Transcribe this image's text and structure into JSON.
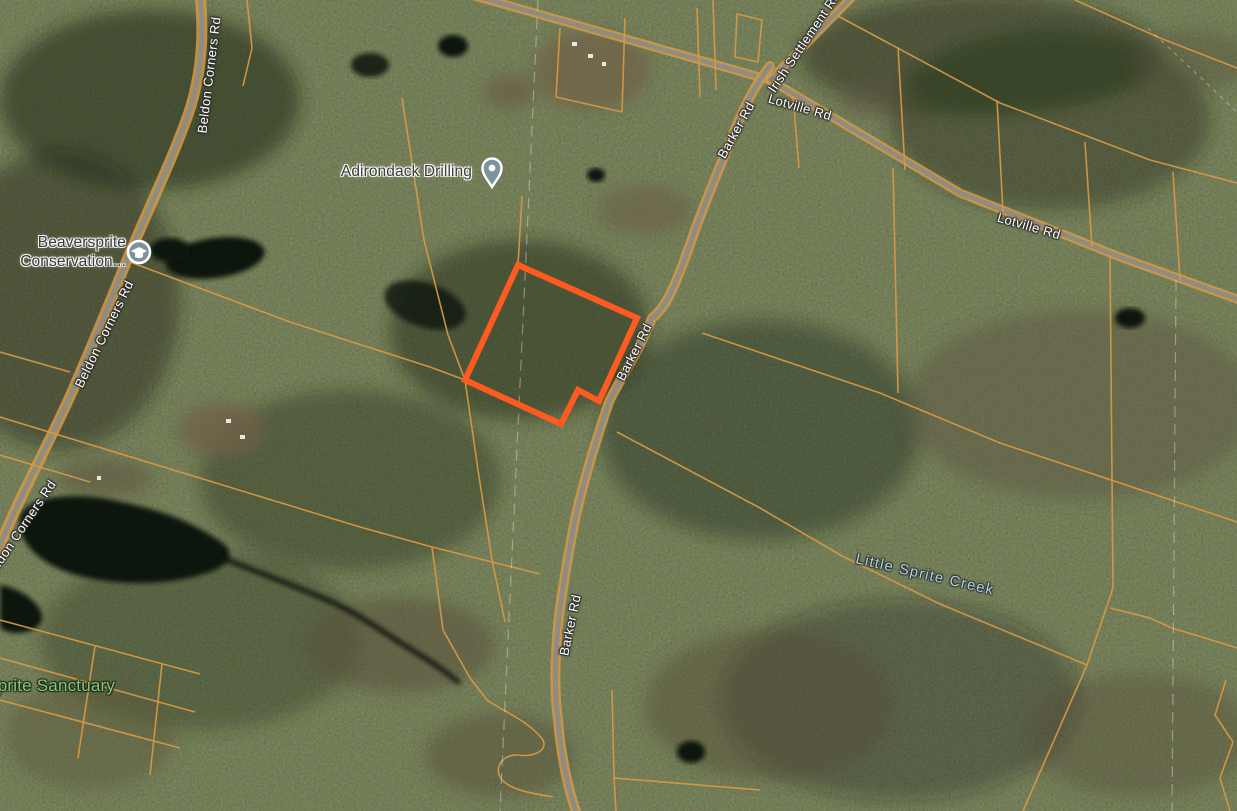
{
  "map_labels": {
    "poi_adirondack": "Adirondack Drilling",
    "poi_beaversprite_line1": "Beaversprite",
    "poi_beaversprite_line2": "Conservation...",
    "road_beldon": "Beldon Corners Rd",
    "road_barker": "Barker Rd",
    "road_lotville": "Lotville Rd",
    "road_irish": "Irish Settlement Rd",
    "water_creek": "Little Sprite Creek",
    "park_sanctuary": "Beaversprite Sanctuary"
  },
  "colors": {
    "highlighted_parcel": "#ff5a1f",
    "parcel_lines": "#d89a45",
    "road_fill": "#8f8c82",
    "poi_label_text": "#3b3b3b",
    "road_label_text": "#ffffff",
    "water_label_text": "#b9d0de",
    "park_label_text": "#83c87b",
    "pin_fill": "#7e929e",
    "water_fill": "#10140d"
  }
}
